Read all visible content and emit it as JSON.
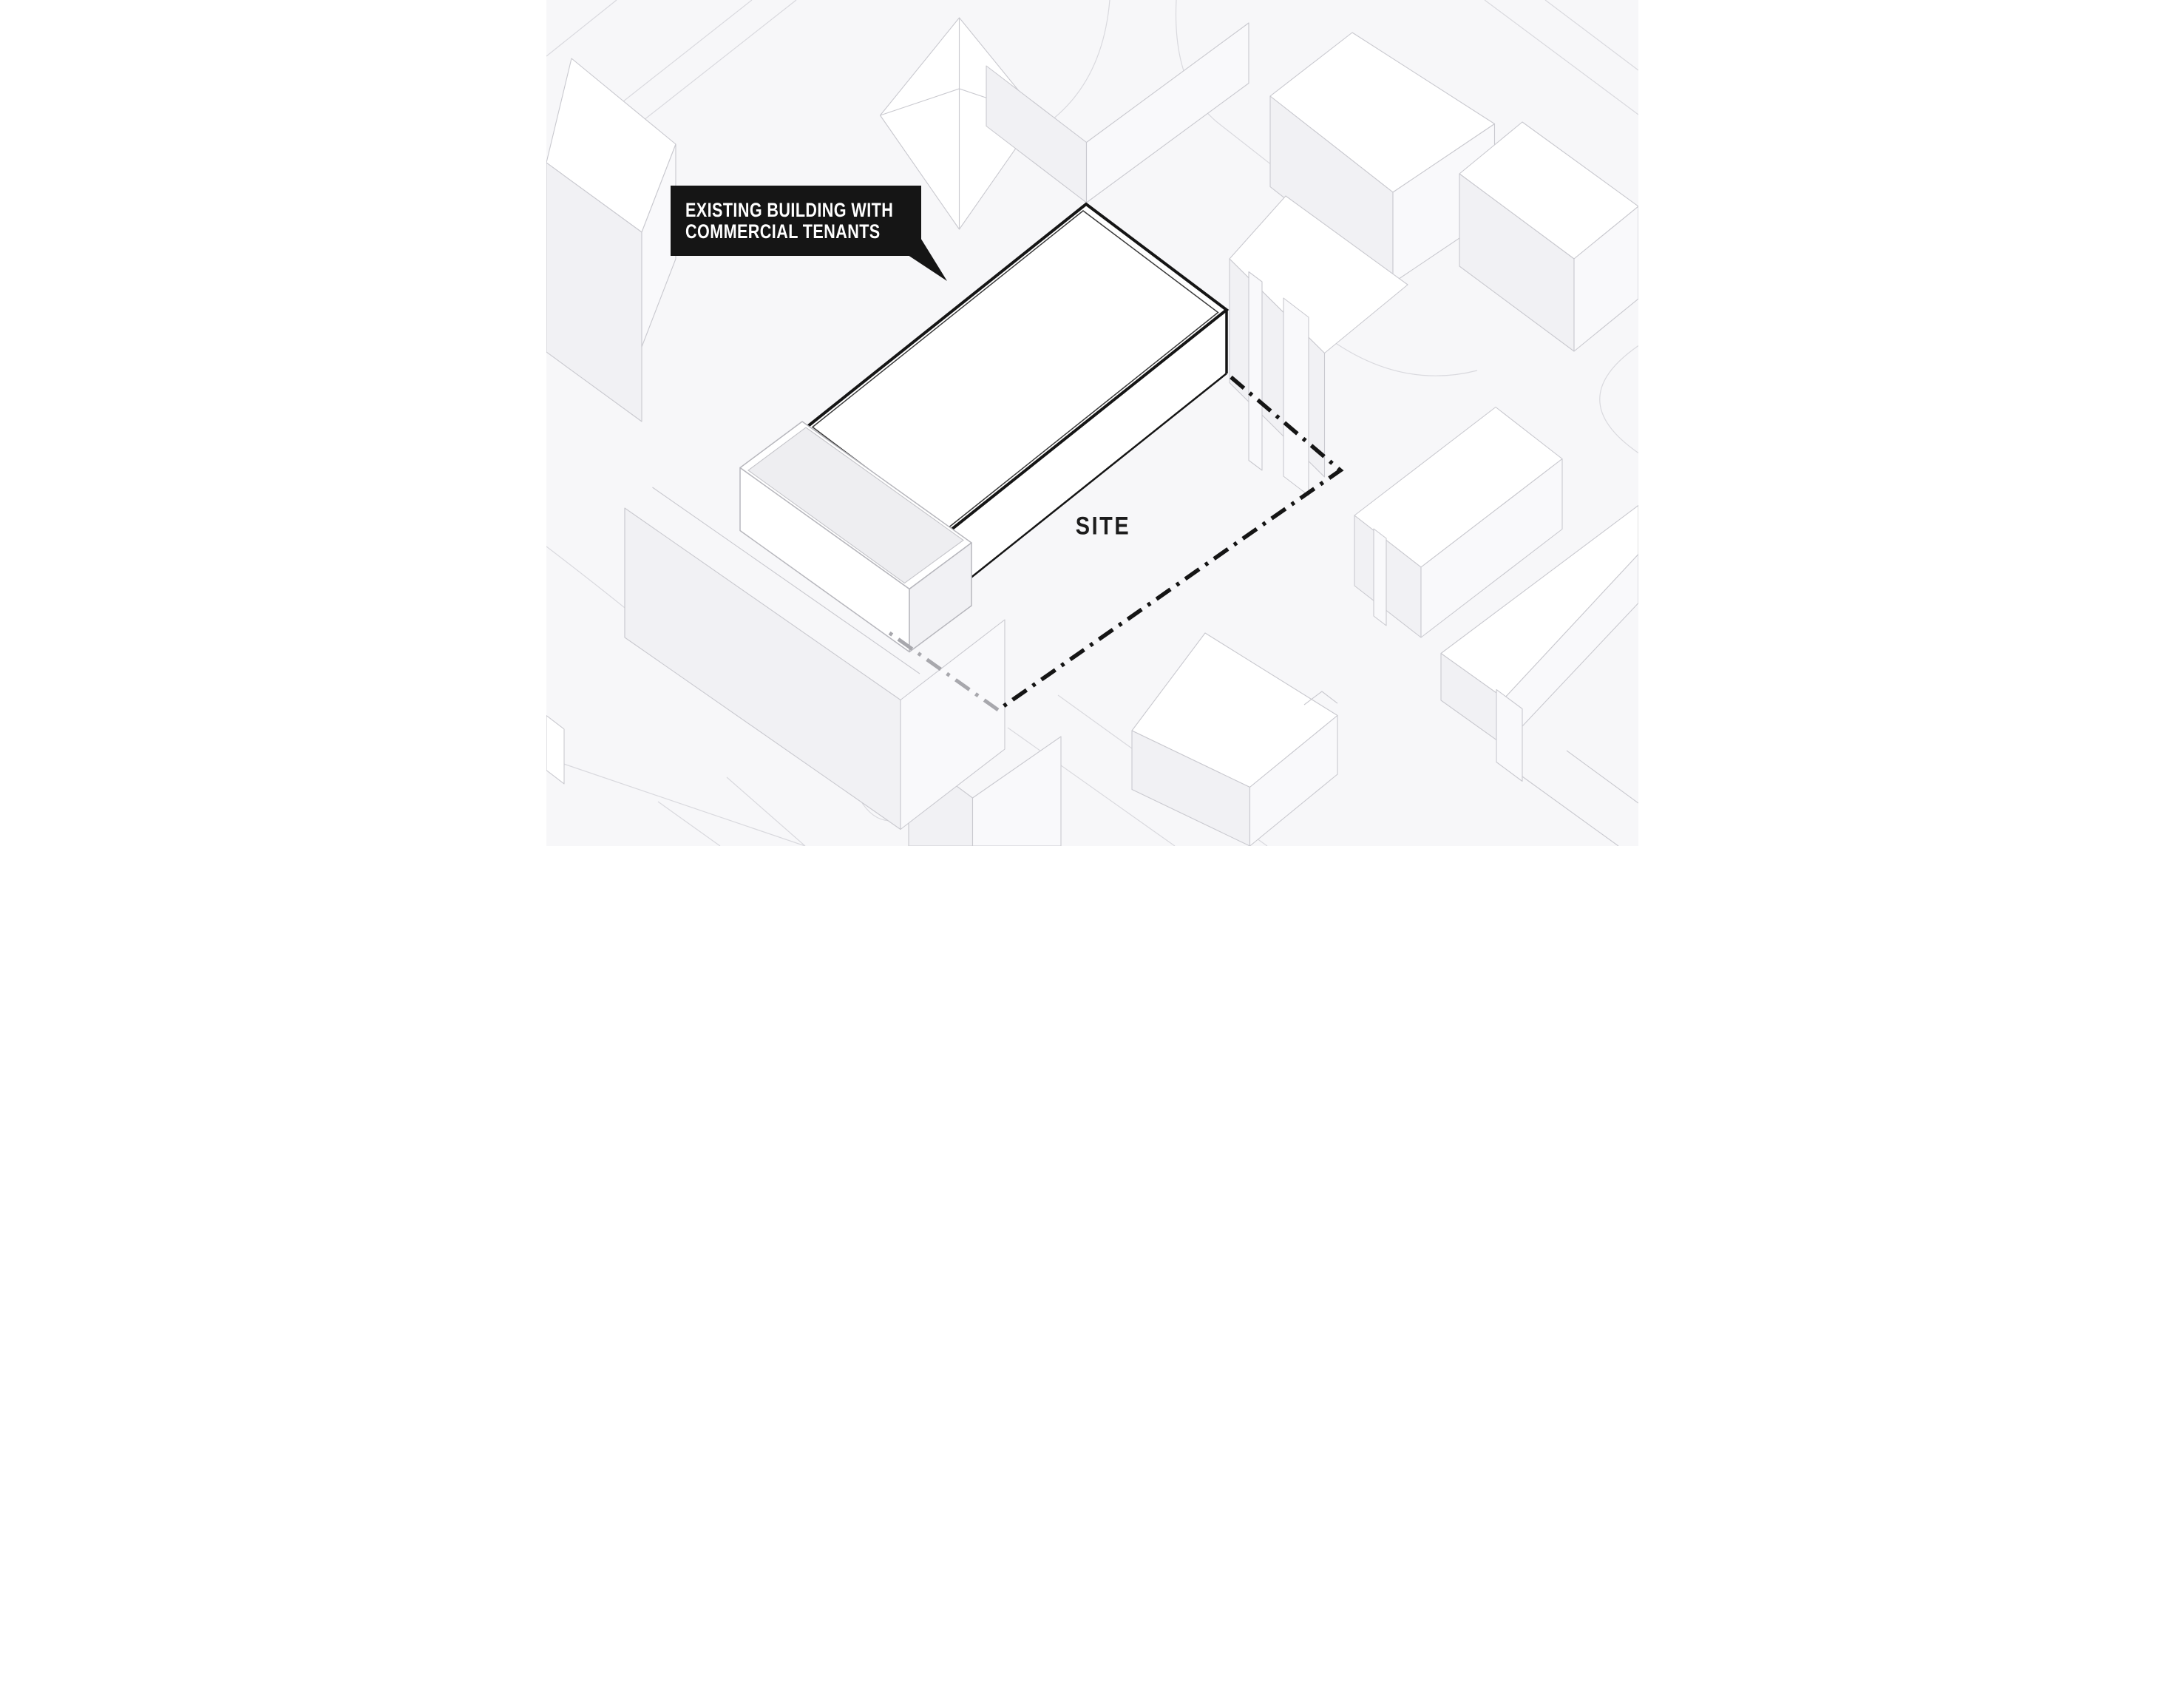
{
  "title": "Axonometric site diagram",
  "callout": {
    "line1": "EXISTING BUILDING WITH",
    "line2": "COMMERCIAL TENANTS"
  },
  "site_label": "SITE",
  "legend": {
    "boundary_style": "dash-dot",
    "boundary_meaning": "site boundary"
  },
  "colors": {
    "paper": "#f7f7f9",
    "ink": "#151515",
    "callout-text": "#ffffff",
    "ctx": "#c9c9cf",
    "street": "#d9d9de",
    "shade": "#f1f1f4",
    "lite": "#f9f9fb",
    "white": "#ffffff",
    "courtyard": "#eeeef1",
    "podline": "#b7b7bd",
    "bgray": "#a8a8ad",
    "inner": "#3a3a3a"
  }
}
